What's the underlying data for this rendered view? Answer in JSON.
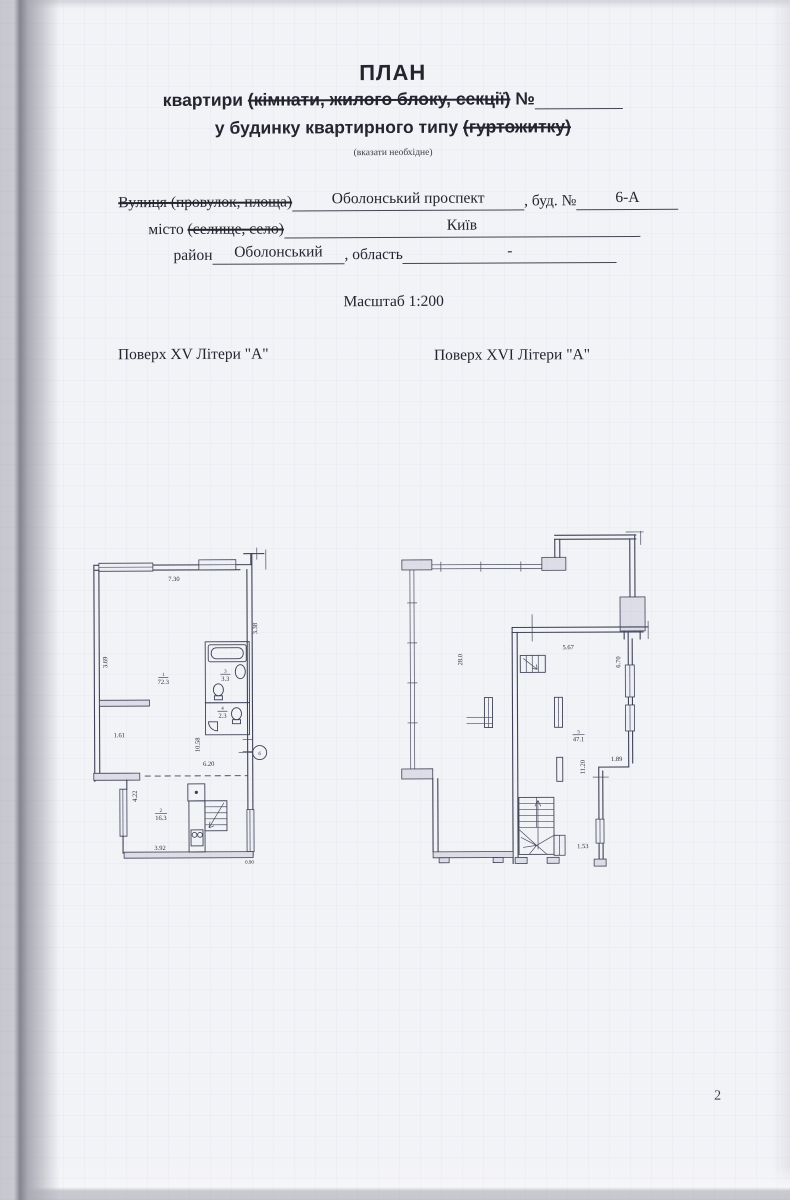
{
  "header": {
    "title": "ПЛАН",
    "line1_pre": "квартири ",
    "line1_struck": "(кімнати, жилого блоку, секції)",
    "line1_post": " №",
    "line2_pre": "у будинку квартирного типу ",
    "line2_struck": "(гуртожитку)",
    "note": "(вказати необхідне)"
  },
  "address": {
    "street_label_struck": "Вулиця (провулок, площа)",
    "street_value": "Оболонський проспект",
    "building_label": ", буд. №",
    "building_value": "6-А",
    "city_label": "місто ",
    "city_label_struck": "(селище, село)",
    "city_value": "Київ",
    "district_label": "район",
    "district_value": "Оболонський",
    "region_label": ", область",
    "region_value": "-"
  },
  "scale_text": "Масштаб 1:200",
  "floors": {
    "left_label": "Поверх XV Літери \"А\"",
    "right_label": "Поверх XVI Літери \"А\""
  },
  "plan_left": {
    "dims": {
      "top": "7.30",
      "right": "3.38",
      "left_upper": "3.69",
      "left_mid": "1.61",
      "shaft": "10.58",
      "hall": "6.20",
      "left_lower": "4.22",
      "bottom": "3.92",
      "corner": "0.90"
    },
    "rooms": {
      "r1_num": "1",
      "r1_area": "72.3",
      "r2_num": "2",
      "r2_area": "16.3",
      "r3_num": "3",
      "r3_area": "3.3",
      "r4_num": "4",
      "r4_area": "2.3"
    },
    "marker": "б"
  },
  "plan_right": {
    "dims": {
      "terrace": "28.0",
      "top": "5.67",
      "right_upper": "6.70",
      "mid": "11.20",
      "right_mid": "1.89",
      "stairs": "1.53"
    },
    "rooms": {
      "r5_num": "5",
      "r5_area": "47.1"
    }
  },
  "page": {
    "number": "2"
  }
}
